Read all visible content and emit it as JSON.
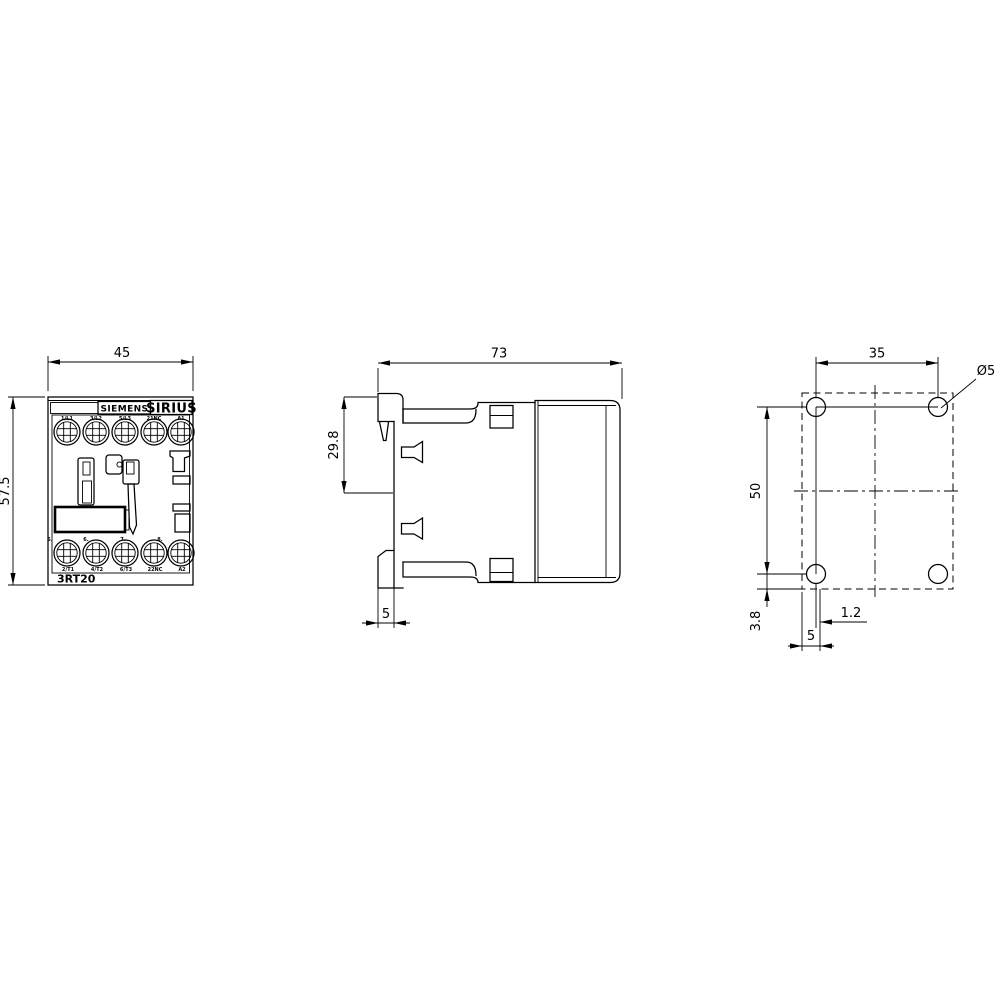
{
  "colors": {
    "line": "#000000",
    "background": "#ffffff"
  },
  "front_view": {
    "width_dim": "45",
    "height_dim": "57.5",
    "brand": "SIEMENS",
    "series": "SIRIUS",
    "model": "3RT20",
    "top_terminals": [
      "1/L1",
      "3/L2",
      "5/L3",
      "21NC",
      "A1"
    ],
    "bottom_terminals": [
      "2/T1",
      "4/T2",
      "6/T3",
      "22NC",
      "A2"
    ],
    "position_markers": [
      "5.",
      "6.",
      "7.",
      "8."
    ]
  },
  "side_view": {
    "width_dim": "73",
    "rail_height_dim": "29.8",
    "clip_depth_dim": "5"
  },
  "mounting_view": {
    "hole_pitch_horizontal": "35",
    "hole_pitch_vertical": "50",
    "hole_diameter": "Ø5",
    "bottom_offset_dim": "3.8",
    "slot_offset_dim": "1.2",
    "edge_offset_dim": "5"
  }
}
